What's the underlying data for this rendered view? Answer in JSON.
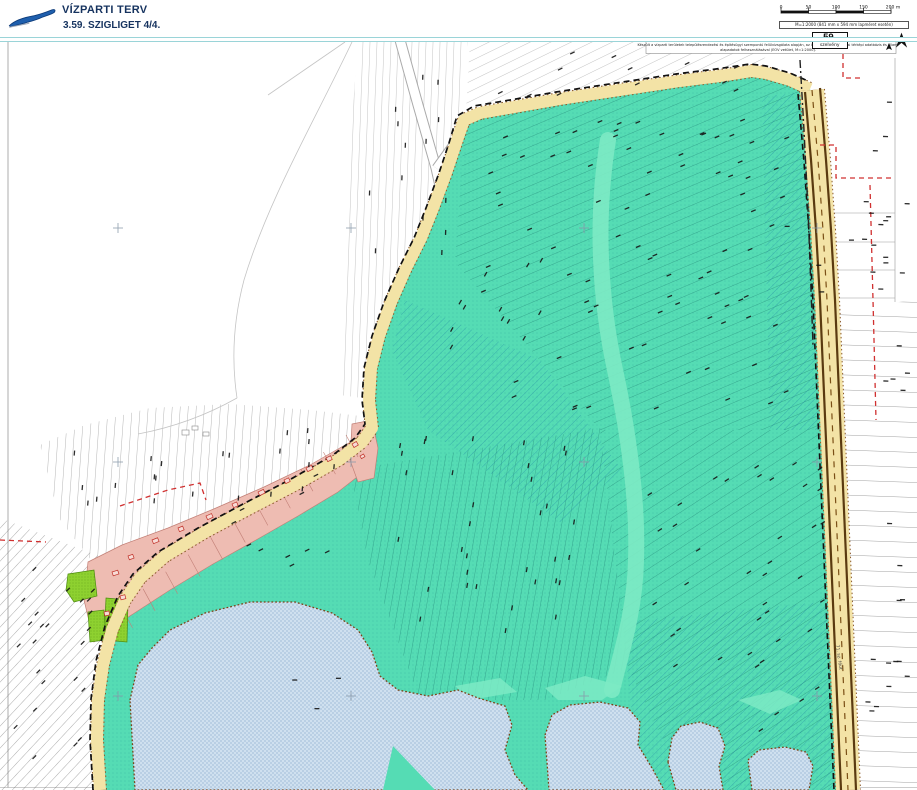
{
  "header": {
    "title": "VÍZPARTI TERV",
    "subtitle": "3.59. SZIGLIGET  4/4."
  },
  "scalebar": {
    "ticks": [
      "0",
      "50",
      "100",
      "150",
      "200 m"
    ],
    "note": "M=1:2000 (841 mm x 594 mm lapméret esetén)"
  },
  "sheet_nav": {
    "prev_arrow": "◄◄",
    "prev": "58.",
    "current_number": "59.",
    "current_label": "szelvény",
    "next": "60.",
    "next_arrow": "►►"
  },
  "disclaimer": {
    "line1": "Készült a vízparti területek településrendezési és építésügyi szempontú felülvizsgálata alapján, az ingatlan-nyilvántartási térképi adatbázis és állami",
    "line2": "alapadatok felhasználásával (EOV vetület, M=1:2000)."
  },
  "map": {
    "road_label": "71. sz. főút"
  },
  "palette": {
    "header_blue": "#16335f",
    "separator_teal": "#9ad4d8",
    "logo_blue": "#1f5fad",
    "teal": "#55dcb4",
    "teal_light": "#7deac4",
    "pink": "#eebcb2",
    "pink_line": "#c27f76",
    "green": "#8ed130",
    "tan": "#f3e3a6",
    "tan_edge": "#8a5a2a",
    "water": "#cfe0ef",
    "water_check": "#b9cfe4",
    "shoreline": "#7a4418",
    "road_brown": "#5a3a10",
    "red_dash": "#d03030",
    "parcel_gray": "#8a8a8a",
    "mark_black": "#151515"
  }
}
